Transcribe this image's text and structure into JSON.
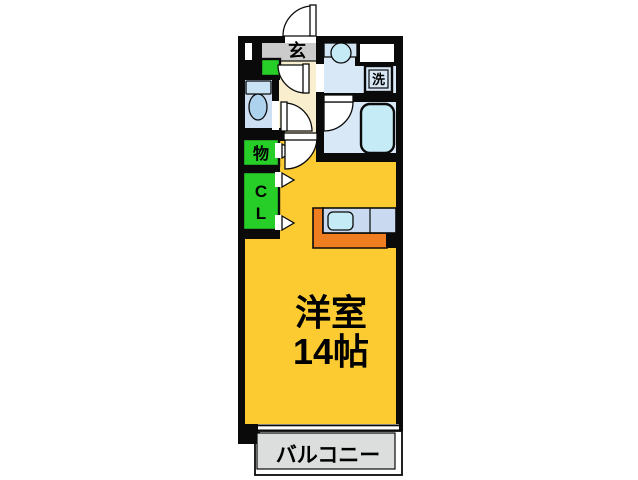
{
  "colors": {
    "wall": "#0a0a0a",
    "room_yellow": "#fccb32",
    "hall_cream": "#f9efce",
    "entrance_gray": "#cbcbcb",
    "wet_floor": "#d9e8f7",
    "toilet_floor": "#cddff2",
    "fixture_cyan": "#c4ebf6",
    "vanity_blue": "#d2e5f5",
    "tank_blue": "#c9e3f4",
    "bowl_blue": "#acd2ee",
    "closet_green": "#28ce28",
    "counter_orange": "#ee7e20",
    "counter_top": "#c9d9ef",
    "balcony_gray": "#dcdede"
  },
  "rooms": {
    "entrance": {
      "label": "玄"
    },
    "laundry": {
      "label": "洗"
    },
    "storage": {
      "label": "物"
    },
    "closet": {
      "line1": "C",
      "line2": "L"
    },
    "main_room": {
      "name": "洋室",
      "size": "14帖"
    },
    "balcony": {
      "label": "バルコニー"
    }
  }
}
